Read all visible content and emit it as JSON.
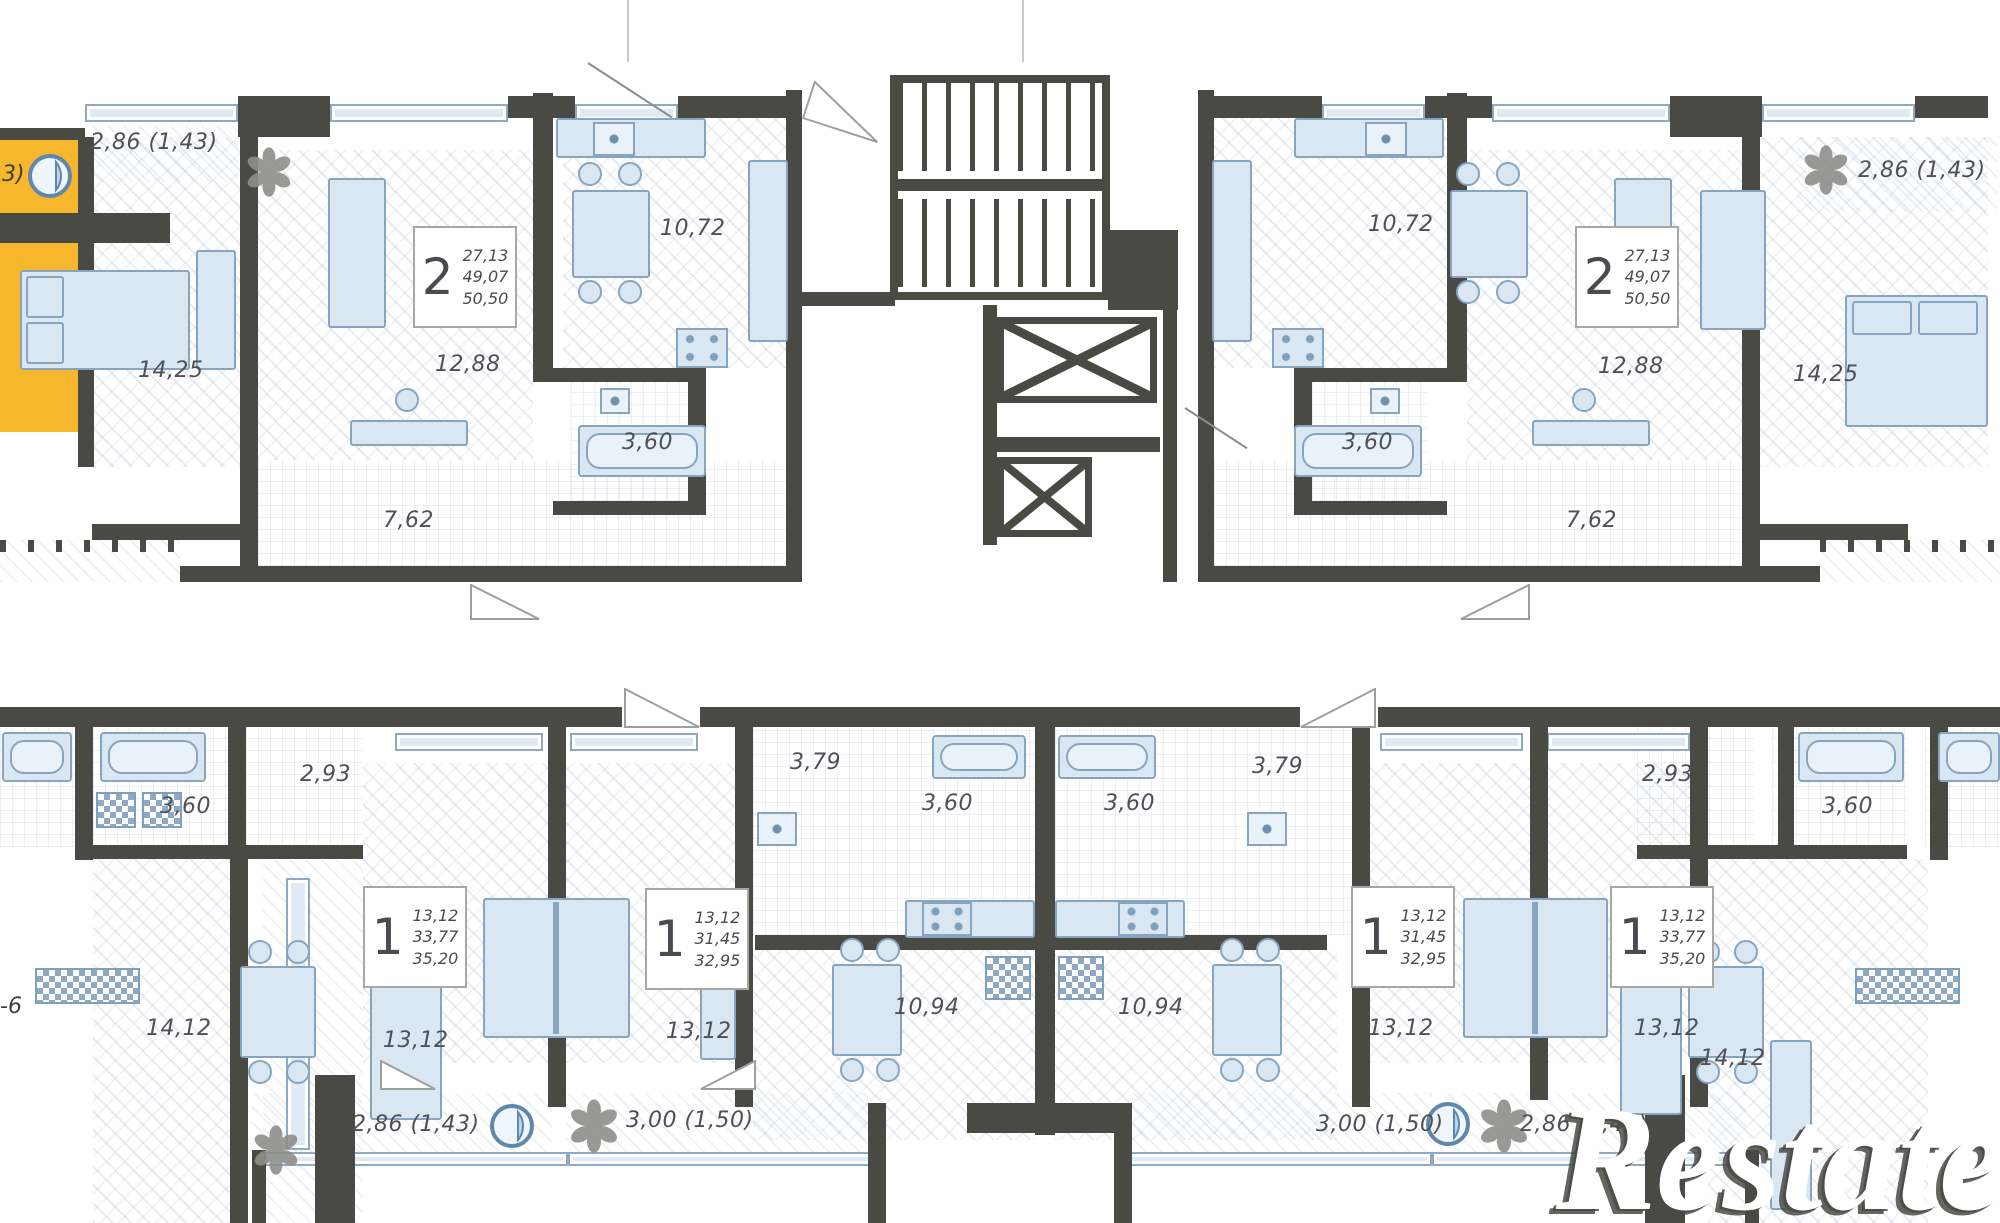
{
  "watermark": {
    "text": "Restate"
  },
  "colors": {
    "wall": "#4a4a45",
    "highlight": "#f6b72c",
    "fixture_fill": "#d9e7f3",
    "fixture_stroke": "#87a5c0",
    "label": "#4f4f58"
  },
  "icons": {
    "plant": "plant-icon",
    "drain_circle": "drain-circle-icon",
    "stairs": "stairs-symbol",
    "elevator": "elevator-x-symbol"
  },
  "top_band": {
    "corner_unit": {
      "number_fragment": "3)"
    },
    "apartment_left": {
      "balcony_area": "2,86 (1,43)",
      "bedroom_area": "14,25",
      "living_area": "12,88",
      "hall_area": "7,62",
      "kitchen_area": "10,72",
      "bath_area": "3,60",
      "stats": {
        "rooms": "2",
        "living_space": "27,13",
        "area": "49,07",
        "total_area": "50,50"
      }
    },
    "apartment_right": {
      "kitchen_area": "10,72",
      "living_area": "12,88",
      "bath_area": "3,60",
      "hall_area": "7,62",
      "bedroom_area": "14,25",
      "balcony_area": "2,86 (1,43)",
      "stats": {
        "rooms": "2",
        "living_space": "27,13",
        "area": "49,07",
        "total_area": "50,50"
      }
    }
  },
  "bottom_band": {
    "edge_unit_left": {
      "number_fragment": "-6"
    },
    "apartment_a": {
      "bath_area": "3,60",
      "hall_area": "2,93",
      "kitchen_living_area": "14,12",
      "room_area": "13,12",
      "balcony_area": "2,86 (1,43)",
      "stats": {
        "rooms": "1",
        "room_space": "13,12",
        "area": "33,77",
        "total_area": "35,20"
      }
    },
    "apartment_b": {
      "room_area": "13,12",
      "hall_area": "3,79",
      "bath_area": "3,60",
      "kitchen_area": "10,94",
      "balcony_area": "3,00 (1,50)",
      "stats": {
        "rooms": "1",
        "room_space": "13,12",
        "area": "31,45",
        "total_area": "32,95"
      }
    },
    "apartment_c": {
      "kitchen_area": "10,94",
      "bath_area": "3,60",
      "hall_area": "3,79",
      "room_area": "13,12",
      "balcony_area": "3,00 (1,50)",
      "stats": {
        "rooms": "1",
        "room_space": "13,12",
        "area": "31,45",
        "total_area": "32,95"
      }
    },
    "apartment_d": {
      "room_area": "13,12",
      "balcony_area": "2,86 (1,43)",
      "stats": {
        "rooms": "1",
        "room_space": "13,12",
        "area": "33,77",
        "total_area": "35,20"
      }
    },
    "apartment_e": {
      "hall_area": "2,93",
      "bath_area": "3,60",
      "kitchen_living_area": "14,12"
    }
  }
}
